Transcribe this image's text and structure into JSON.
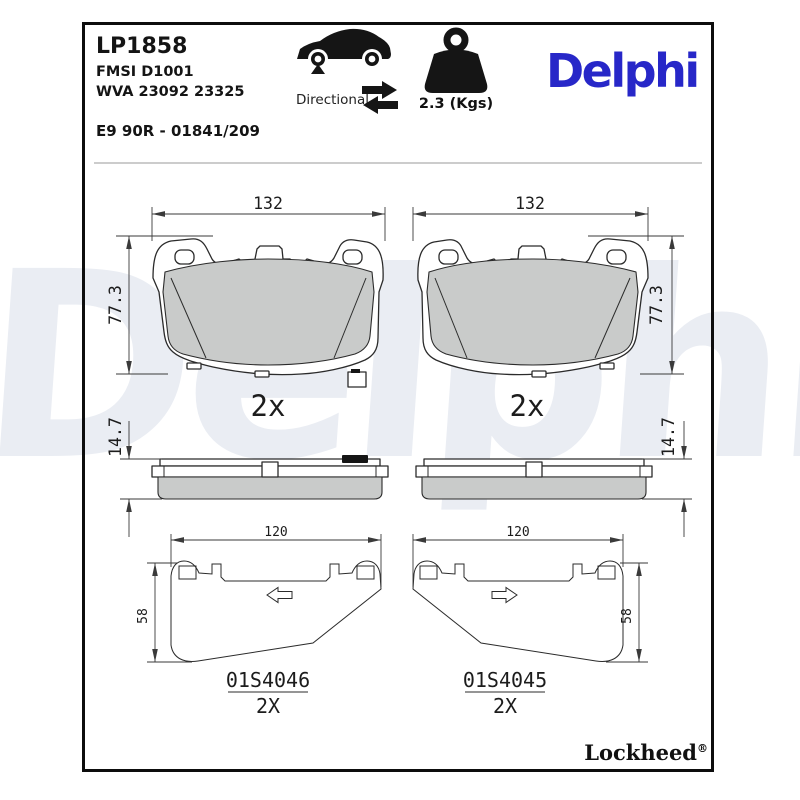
{
  "header": {
    "part_number": "LP1858",
    "fmsi": "FMSI D1001",
    "wva": "WVA 23092 23325",
    "homologation": "E9 90R - 01841/209",
    "directional_label": "Directional",
    "weight_label": "2.3 (Kgs)",
    "brand_logo": "Delphi"
  },
  "pads": {
    "width_mm": "132",
    "height_mm": "77.3",
    "thickness_mm": "14.7",
    "quantity_label": "2x"
  },
  "shims": {
    "width_mm": "120",
    "height_mm": "58",
    "left_code": "01S4046",
    "right_code": "01S4045",
    "quantity_label": "2X"
  },
  "icons": {
    "car": "car-silhouette-with-front-axle-marker",
    "directional_arrows": "double-opposing-arrows",
    "weight": "kettlebell-weight"
  },
  "watermark_text": "Delphi",
  "footer": {
    "brand": "Lockheed",
    "registered_mark": "®"
  },
  "colors": {
    "delphi_blue": "#2727c8",
    "friction_gray": "#c9cbca",
    "drawing_line": "#2b2b2b",
    "watermark": "#eaedf3",
    "frame": "#0d0d0d"
  }
}
